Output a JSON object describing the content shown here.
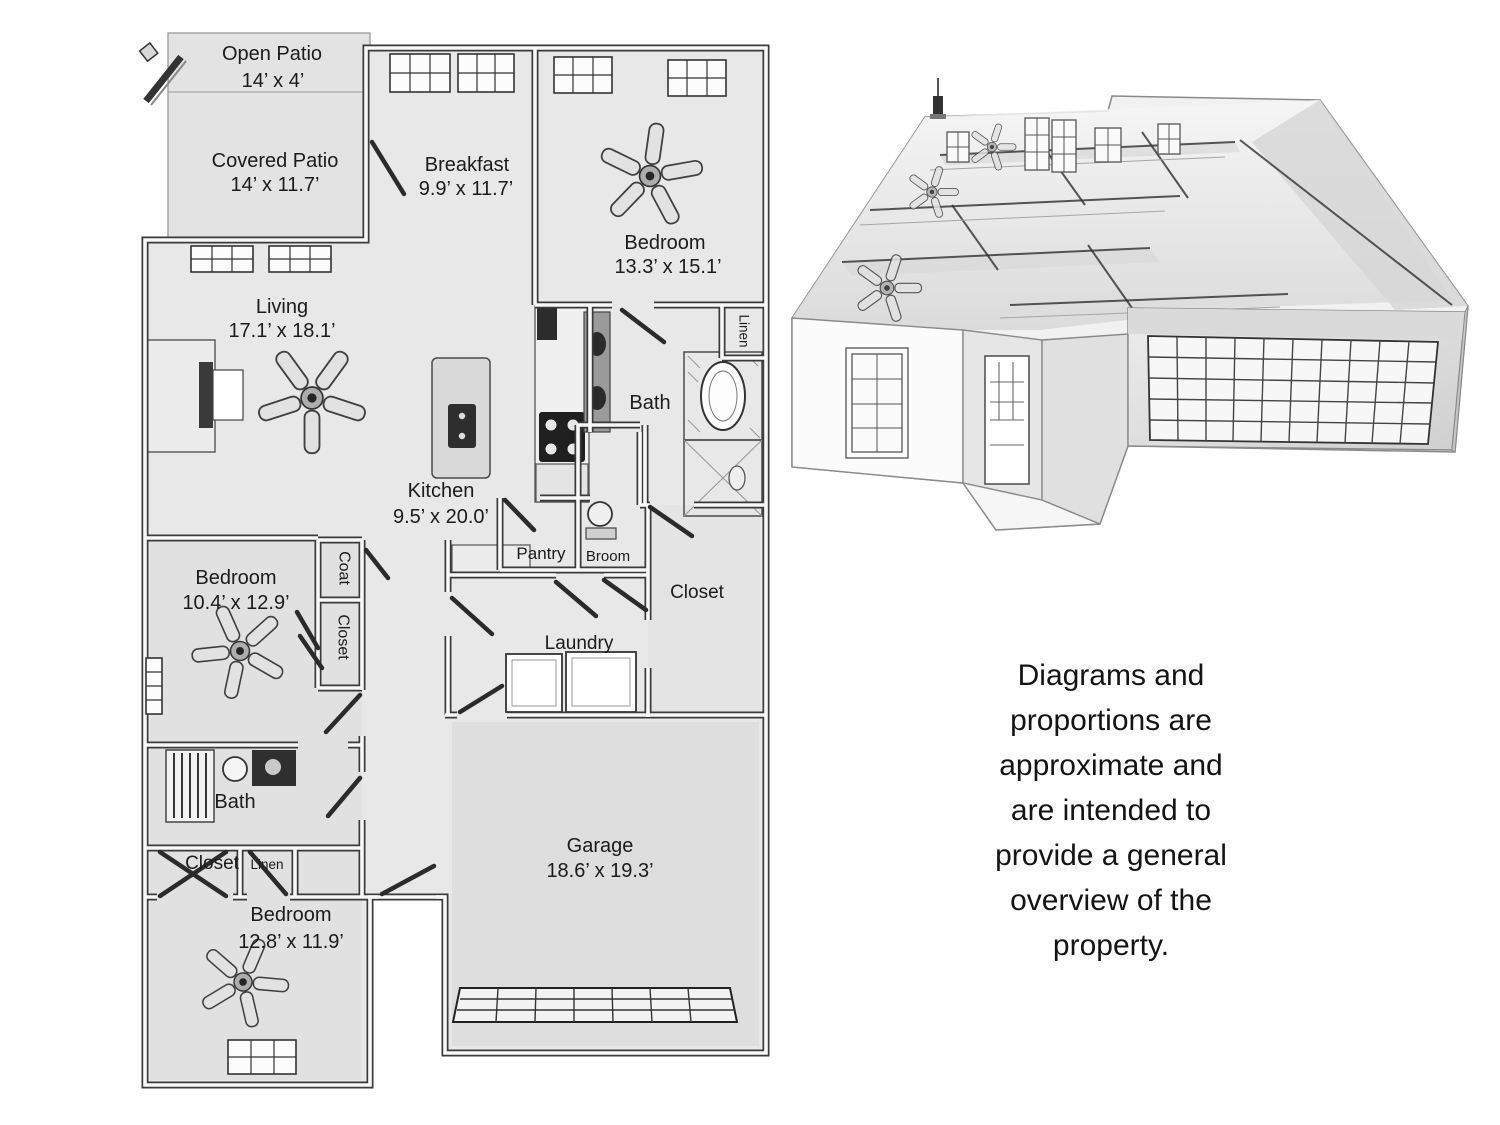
{
  "floor_plan": {
    "rooms": [
      {
        "id": "open-patio",
        "name": "Open Patio",
        "dims": "14’ x 4’"
      },
      {
        "id": "covered-patio",
        "name": "Covered Patio",
        "dims": "14’ x 11.7’"
      },
      {
        "id": "breakfast",
        "name": "Breakfast",
        "dims": "9.9’ x 11.7’"
      },
      {
        "id": "bedroom-upper-right",
        "name": "Bedroom",
        "dims": "13.3’ x 15.1’"
      },
      {
        "id": "living",
        "name": "Living",
        "dims": "17.1’ x 18.1’"
      },
      {
        "id": "kitchen",
        "name": "Kitchen",
        "dims": "9.5’ x 20.0’"
      },
      {
        "id": "bedroom-middle-left",
        "name": "Bedroom",
        "dims": "10.4’ x 12.9’"
      },
      {
        "id": "bedroom-bottom-left",
        "name": "Bedroom",
        "dims": "12.8’ x 11.9’"
      },
      {
        "id": "garage",
        "name": "Garage",
        "dims": "18.6’ x 19.3’"
      }
    ],
    "labels": {
      "bath_top": "Bath",
      "linen_top": "Linen",
      "pantry": "Pantry",
      "broom": "Broom",
      "closet_master": "Closet",
      "coat": "Coat",
      "closet_hall": "Closet",
      "laundry": "Laundry",
      "bath_bottom": "Bath",
      "closet_bottom": "Closet",
      "linen_bottom": "Linen"
    }
  },
  "disclaimer": {
    "lines": [
      "Diagrams and",
      "proportions are",
      "approximate and",
      "are intended to",
      "provide a general",
      "overview of the",
      "property."
    ]
  },
  "colors": {
    "background": "#ffffff",
    "floor": "#e8e8e8",
    "patio": "#e3e3e3",
    "garage_floor": "#dedede",
    "wall_line": "#3a3a3a",
    "label_text": "#1b1b1b"
  }
}
